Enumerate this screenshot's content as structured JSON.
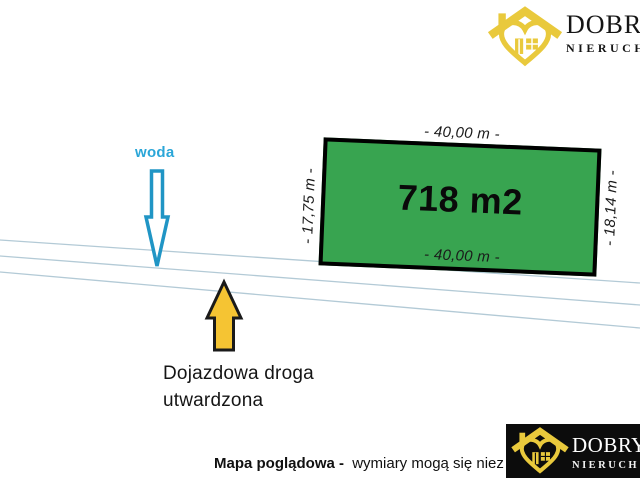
{
  "plot": {
    "area": "718 m2",
    "dim_top": "- 40,00 m -",
    "dim_bottom": "- 40,00 m -",
    "dim_left": "- 17,75 m -",
    "dim_right": "- 18,14 m -"
  },
  "annotations": {
    "water": "woda",
    "road_line1": "Dojazdowa droga",
    "road_line2": "utwardzona"
  },
  "footer": {
    "note_bold": "Mapa poglądowa -",
    "note_rest": "wymiary mogą się niez"
  },
  "brand": {
    "top": {
      "name": "DOBRY",
      "sub": "NIERUCH"
    },
    "bottom": {
      "name": "DOBRY",
      "sub": "NIERUCH"
    }
  },
  "colors": {
    "plot_fill": "#38a450",
    "plot_border": "#000000",
    "parcel_line": "#b3cad6",
    "water_arrow_blue": "#2095c5",
    "water_text_blue": "#2aa6d8",
    "road_arrow_yellow": "#f5c433",
    "brand_yellow": "#e9c93c",
    "brand_box_black": "#0c0c0c"
  },
  "icons": {
    "water_arrow": "down-arrow-icon",
    "road_arrow": "up-arrow-icon",
    "brand": "house-heart-icon"
  }
}
